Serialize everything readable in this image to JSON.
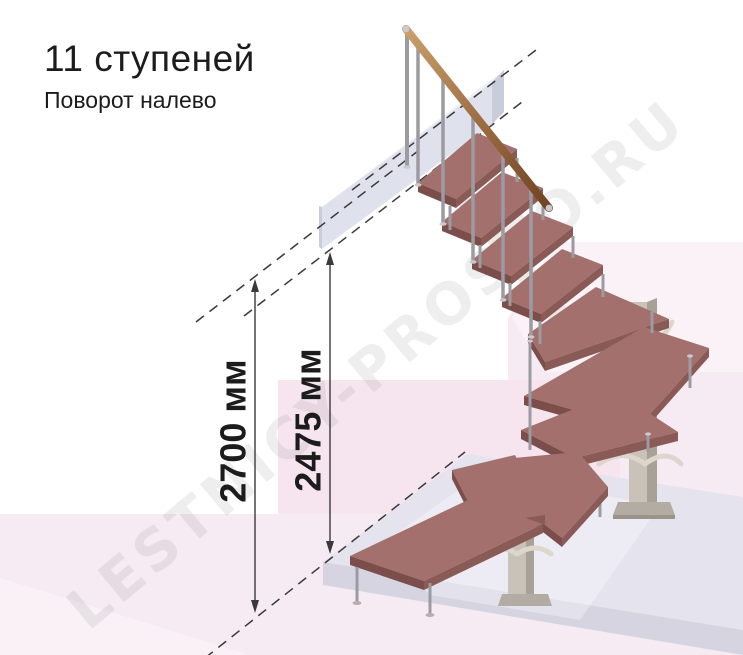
{
  "header": {
    "title": "11 ступеней",
    "subtitle": "Поворот налево"
  },
  "watermark": {
    "text": "LESTNICY-PROSTO.RU"
  },
  "dims": {
    "total_height_label": "2700 мм",
    "upper_height_label": "2475 мм"
  },
  "colors": {
    "bg_pink": "#f7ebf3",
    "bg_pink_rect": "#f3d9e7",
    "block_front": "#dfe2ec",
    "block_top": "#eff1f7",
    "block_edge": "#c9cdda",
    "slab_top": "#e5e3ee",
    "slab_front": "#d7d4e2",
    "column": "#c9c2b9",
    "column_shade": "#a8a198",
    "column_base": "#b3aca3",
    "branch": "#dcd6cb",
    "support": "#ebe9e3",
    "tread_top": "#a4706d",
    "tread_front": "#7b4e4b",
    "tread_side": "#8a5a57",
    "metal": "#9b9ba1",
    "metal_cap": "#c9c9cf",
    "rail_light": "#c99c68",
    "rail_dark": "#6f4424",
    "dimension": "#3a3a3a",
    "text": "#1c1c1c",
    "watermark_gray": "#4a4a4a"
  }
}
